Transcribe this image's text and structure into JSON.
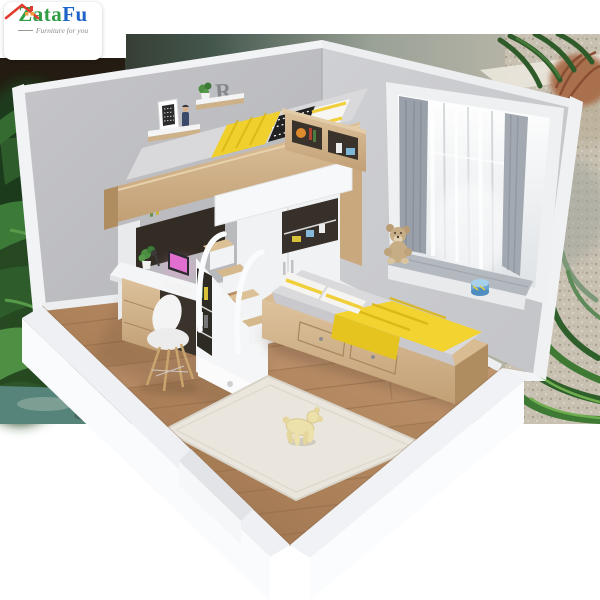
{
  "image": {
    "description": "3D cutaway render of a children's bedroom set: loft bed with desk, storage stairs and wardrobe underneath, a single bed with yellow blanket, bay window with teddy bear, wall shelves, rug and toy dog, shown against an outdoor backdrop"
  },
  "brand": {
    "logo_icon": "house-roof-icon",
    "name_part_1": "Zata",
    "name_part_2": "Fu",
    "tagline": "Furniture for you",
    "colors": {
      "name_part_1": "#2f9e44",
      "name_part_2": "#1e63c8",
      "roof_red": "#e23b2e",
      "window_orange": "#f0a03c",
      "tagline_gray": "#8b8b85"
    }
  },
  "decor": {
    "shelf_letter": "R"
  },
  "palette": {
    "wall_gray": "#c7c8cc",
    "trim_white": "#f2f3f5",
    "wood_light": "#d2b28a",
    "floor_wood": "#b0855f",
    "accent_yellow": "#f2d32f",
    "mattress_gray": "#d8d8da",
    "curtain_gray": "#9aa0a9",
    "foliage_green": "#3c7a38"
  }
}
